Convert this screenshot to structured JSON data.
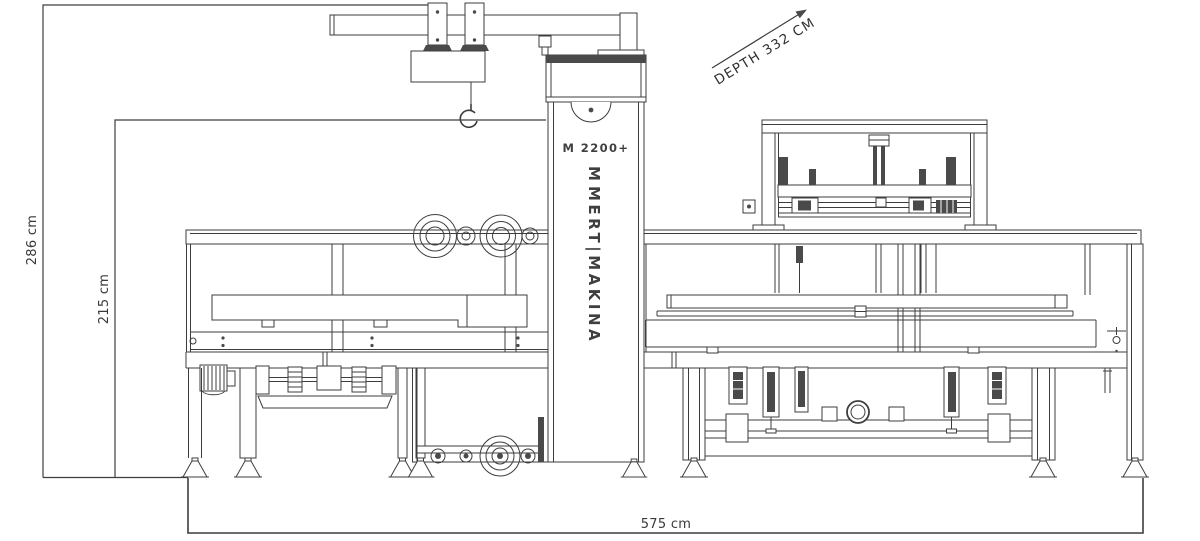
{
  "canvas": {
    "background": "#ffffff",
    "line_color": "#3d3d3d",
    "dark_fill": "#4a4a4a",
    "text_color": "#3a3a3a"
  },
  "machine": {
    "model": "M 2200+",
    "brand_logo": "M",
    "brand_name": "MERT|MAKINA"
  },
  "dimensions": {
    "total_height": "286 cm",
    "column_height": "215 cm",
    "depth": "DEPTH 332 CM",
    "width": "575 cm"
  }
}
